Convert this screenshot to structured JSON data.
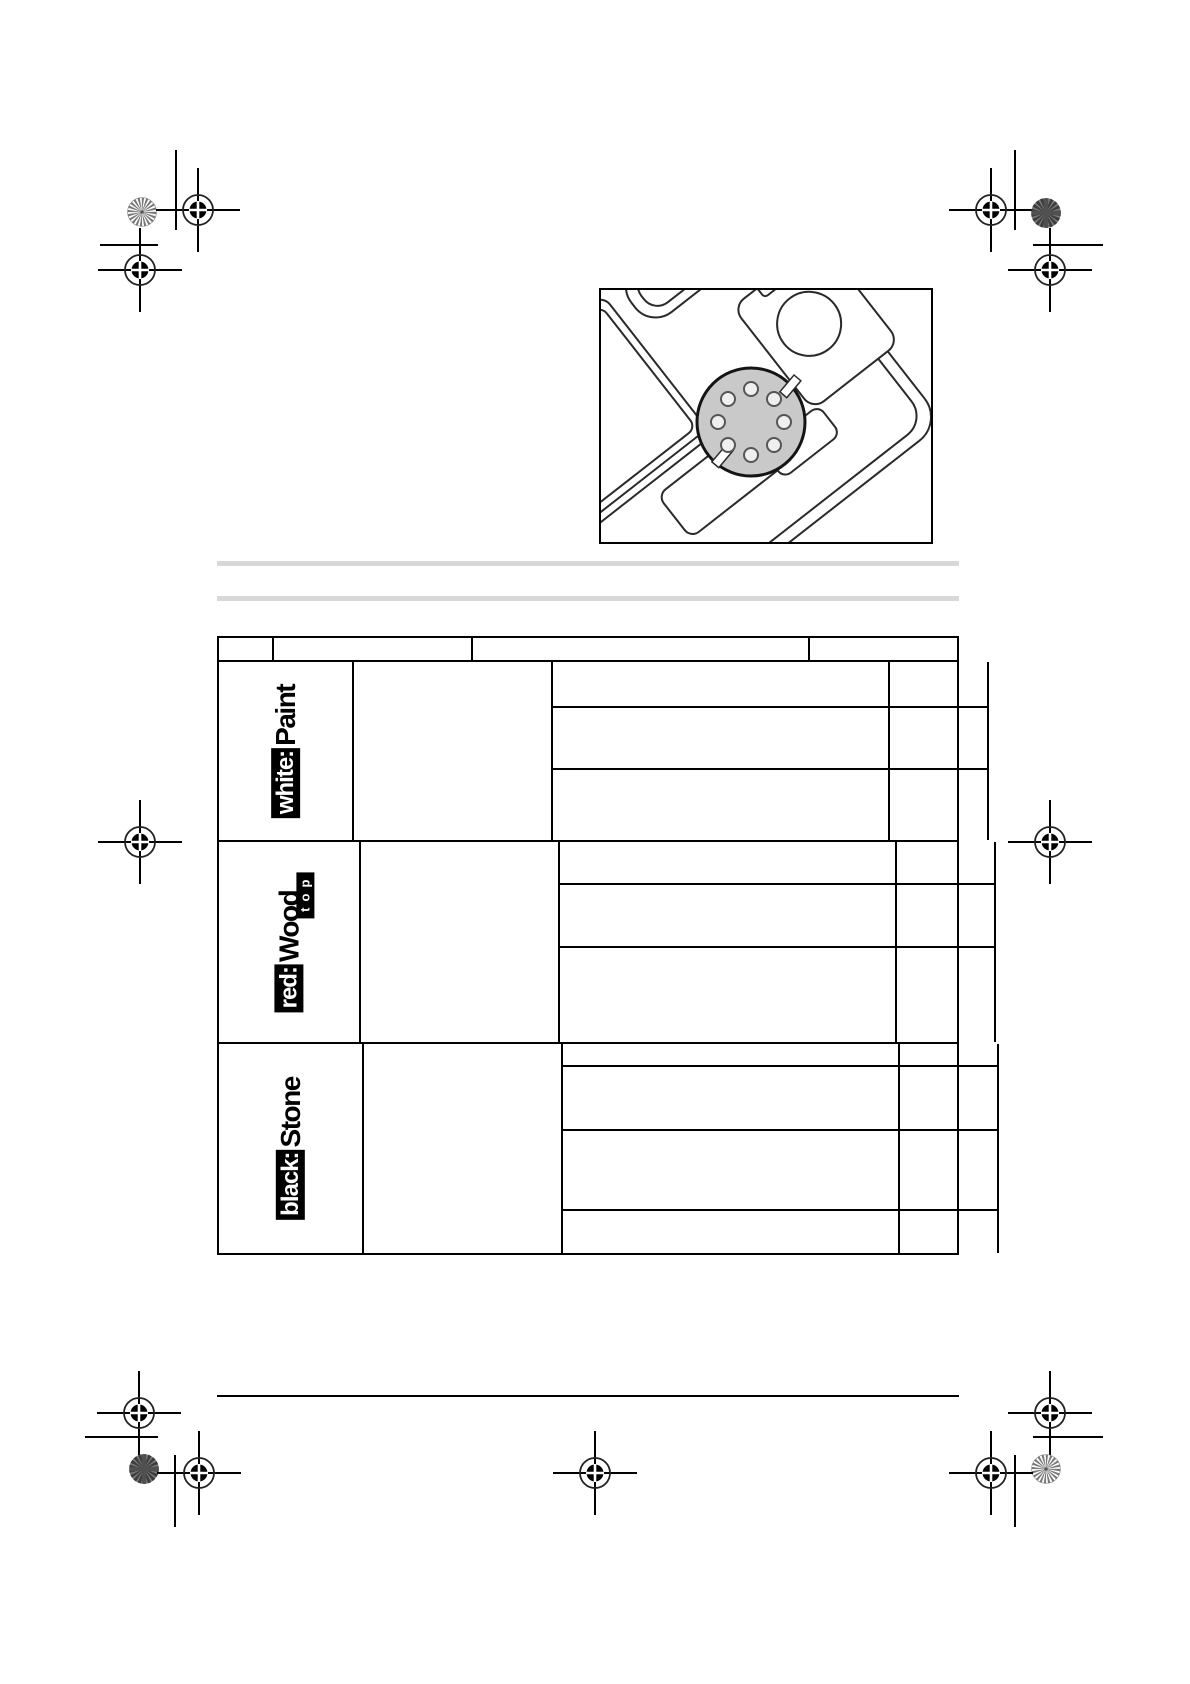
{
  "page": {
    "width": 1190,
    "height": 1684,
    "background": "#ffffff"
  },
  "colors": {
    "table_line": "#000000",
    "separator_grey": "#d8d8d8",
    "pad_fill": "#c9c9c9",
    "logo_bg": "#000000",
    "logo_fg": "#ffffff"
  },
  "illustration": {
    "name": "carrying-case-with-sanding-pad",
    "pad_hole_count": 8
  },
  "table": {
    "header": {
      "columns": [
        "",
        "",
        "",
        ""
      ]
    },
    "groups": [
      {
        "brand_prefix": "white:",
        "brand_name": "Paint",
        "brand_suffix": "",
        "rows": [
          "",
          "",
          ""
        ]
      },
      {
        "brand_prefix": "red:",
        "brand_name": "Wood",
        "brand_suffix": "top",
        "rows": [
          "",
          "",
          ""
        ]
      },
      {
        "brand_prefix": "black:",
        "brand_name": "Stone",
        "brand_suffix": "",
        "rows": [
          "",
          "",
          "",
          ""
        ]
      }
    ]
  }
}
